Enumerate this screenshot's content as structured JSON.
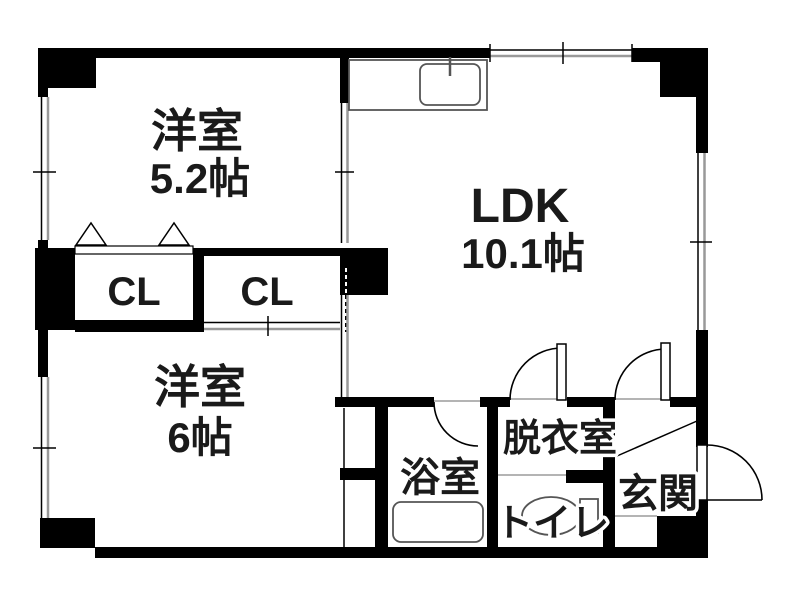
{
  "plan": {
    "type": "apartment-floorplan",
    "colors": {
      "wall": "#000000",
      "background": "#ffffff",
      "window_line": "#999999"
    },
    "rooms": {
      "western_room_top": {
        "label": "洋室",
        "size": "5.2帖"
      },
      "ldk": {
        "label": "LDK",
        "size": "10.1帖"
      },
      "western_room_bottom": {
        "label": "洋室",
        "size": "6帖"
      },
      "closet_left": {
        "label": "CL"
      },
      "closet_right": {
        "label": "CL"
      },
      "bathroom": {
        "label": "浴室"
      },
      "dressing_room": {
        "label": "脱衣室"
      },
      "toilet": {
        "label": "トイレ"
      },
      "entrance": {
        "label": "玄関"
      }
    }
  }
}
